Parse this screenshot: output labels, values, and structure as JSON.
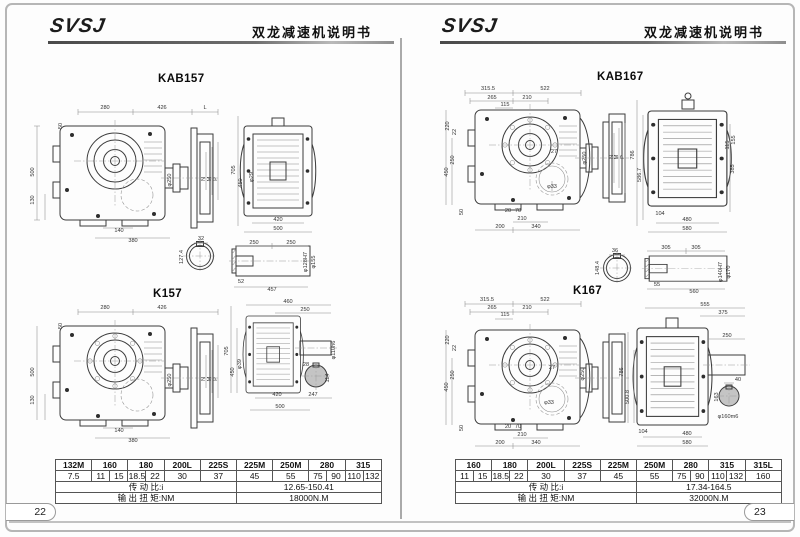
{
  "pages": [
    {
      "number": "22",
      "header": {
        "logo": "SVSJ",
        "doc_title": "双龙减速机说明书"
      },
      "figures": [
        {
          "title": "KAB157",
          "labels": [
            {
              "t": "280",
              "x": 80,
              "y": 49
            },
            {
              "t": "426",
              "x": 137,
              "y": 49
            },
            {
              "t": "L",
              "x": 180,
              "y": 49
            },
            {
              "t": "50",
              "x": 37,
              "y": 66,
              "r": 1
            },
            {
              "t": "500",
              "x": 9,
              "y": 112,
              "r": 1
            },
            {
              "t": "130",
              "x": 9,
              "y": 140,
              "r": 1
            },
            {
              "t": "140",
              "x": 94,
              "y": 172
            },
            {
              "t": "380",
              "x": 108,
              "y": 182
            },
            {
              "t": "φ250",
              "x": 146,
              "y": 120,
              "r": 1
            },
            {
              "t": "N",
              "x": 180,
              "y": 119,
              "r": 1
            },
            {
              "t": "M",
              "x": 186,
              "y": 119,
              "r": 1
            },
            {
              "t": "P",
              "x": 192,
              "y": 119,
              "r": 1
            },
            {
              "t": "705",
              "x": 210,
              "y": 110,
              "r": 1
            },
            {
              "t": "450",
              "x": 217,
              "y": 123,
              "r": 1
            },
            {
              "t": "φ29",
              "x": 228,
              "y": 117,
              "r": 1
            },
            {
              "t": "420",
              "x": 253,
              "y": 161
            },
            {
              "t": "500",
              "x": 253,
              "y": 170
            },
            {
              "t": "32",
              "x": 176,
              "y": 180
            },
            {
              "t": "127.4",
              "x": 158,
              "y": 197,
              "r": 1
            },
            {
              "t": "250",
              "x": 229,
              "y": 184
            },
            {
              "t": "250",
              "x": 266,
              "y": 184
            },
            {
              "t": "52",
              "x": 216,
              "y": 223
            },
            {
              "t": "457",
              "x": 247,
              "y": 231
            },
            {
              "t": "φ128H7",
              "x": 282,
              "y": 202,
              "r": 1
            },
            {
              "t": "φ155",
              "x": 290,
              "y": 202,
              "r": 1
            }
          ]
        },
        {
          "title": "K157",
          "labels": [
            {
              "t": "280",
              "x": 80,
              "y": 249
            },
            {
              "t": "426",
              "x": 137,
              "y": 249
            },
            {
              "t": "50",
              "x": 37,
              "y": 266,
              "r": 1
            },
            {
              "t": "500",
              "x": 9,
              "y": 312,
              "r": 1
            },
            {
              "t": "130",
              "x": 9,
              "y": 340,
              "r": 1
            },
            {
              "t": "140",
              "x": 94,
              "y": 372
            },
            {
              "t": "380",
              "x": 108,
              "y": 382
            },
            {
              "t": "φ250",
              "x": 146,
              "y": 320,
              "r": 1
            },
            {
              "t": "N",
              "x": 180,
              "y": 319,
              "r": 1
            },
            {
              "t": "M",
              "x": 186,
              "y": 319,
              "r": 1
            },
            {
              "t": "P",
              "x": 192,
              "y": 319,
              "r": 1
            },
            {
              "t": "460",
              "x": 263,
              "y": 243
            },
            {
              "t": "250",
              "x": 280,
              "y": 251
            },
            {
              "t": "705",
              "x": 203,
              "y": 291,
              "r": 1
            },
            {
              "t": "450",
              "x": 209,
              "y": 312,
              "r": 1
            },
            {
              "t": "φ39",
              "x": 216,
              "y": 304,
              "r": 1
            },
            {
              "t": "420",
              "x": 252,
              "y": 336
            },
            {
              "t": "247",
              "x": 288,
              "y": 336
            },
            {
              "t": "500",
              "x": 255,
              "y": 348
            },
            {
              "t": "φ110h6",
              "x": 310,
              "y": 290,
              "r": 1
            },
            {
              "t": "28",
              "x": 281,
              "y": 306
            },
            {
              "t": "114",
              "x": 304,
              "y": 318,
              "r": 1
            }
          ]
        }
      ],
      "table": {
        "models": [
          "132M",
          "160",
          "180",
          "200L",
          "225S",
          "225M",
          "250M",
          "280",
          "315"
        ],
        "powers": [
          "7.5",
          "11",
          "15",
          "18.5",
          "22",
          "30",
          "37",
          "45",
          "55",
          "75",
          "90",
          "110",
          "132"
        ],
        "ratio_label": "传 动 比:i",
        "ratio_value": "12.65-150.41",
        "torque_label": "输 出 扭 矩:NM",
        "torque_value": "18000N.M"
      }
    },
    {
      "number": "23",
      "header": {
        "logo": "SVSJ",
        "doc_title": "双龙减速机说明书"
      },
      "figures": [
        {
          "title": "KAB167",
          "labels": [
            {
              "t": "315.5",
              "x": 63,
              "y": 30
            },
            {
              "t": "522",
              "x": 120,
              "y": 30
            },
            {
              "t": "265",
              "x": 67,
              "y": 39
            },
            {
              "t": "210",
              "x": 102,
              "y": 39
            },
            {
              "t": "115",
              "x": 80,
              "y": 46
            },
            {
              "t": "220",
              "x": 24,
              "y": 66,
              "r": 1
            },
            {
              "t": "22",
              "x": 31,
              "y": 72,
              "r": 1
            },
            {
              "t": "250",
              "x": 29,
              "y": 100,
              "r": 1
            },
            {
              "t": "450",
              "x": 23,
              "y": 112,
              "r": 1
            },
            {
              "t": "50",
              "x": 38,
              "y": 152,
              "r": 1
            },
            {
              "t": "20",
              "x": 83,
              "y": 152
            },
            {
              "t": "70",
              "x": 93,
              "y": 152
            },
            {
              "t": "210",
              "x": 97,
              "y": 160
            },
            {
              "t": "200",
              "x": 75,
              "y": 168
            },
            {
              "t": "340",
              "x": 111,
              "y": 168
            },
            {
              "t": "φ33",
              "x": 127,
              "y": 128
            },
            {
              "t": "27",
              "x": 129,
              "y": 93
            },
            {
              "t": "φ250",
              "x": 161,
              "y": 98,
              "r": 1
            },
            {
              "t": "N",
              "x": 188,
              "y": 97,
              "r": 1
            },
            {
              "t": "M",
              "x": 193,
              "y": 97,
              "r": 1
            },
            {
              "t": "P",
              "x": 199,
              "y": 97,
              "r": 1
            },
            {
              "t": "786",
              "x": 209,
              "y": 95,
              "r": 1
            },
            {
              "t": "586.7",
              "x": 216,
              "y": 115,
              "r": 1
            },
            {
              "t": "104",
              "x": 235,
              "y": 155
            },
            {
              "t": "480",
              "x": 262,
              "y": 161
            },
            {
              "t": "580",
              "x": 262,
              "y": 170
            },
            {
              "t": "155",
              "x": 310,
              "y": 80,
              "r": 1
            },
            {
              "t": "115",
              "x": 304,
              "y": 85,
              "r": 1
            },
            {
              "t": "385",
              "x": 309,
              "y": 109,
              "r": 1
            },
            {
              "t": "36",
              "x": 190,
              "y": 192
            },
            {
              "t": "148.4",
              "x": 174,
              "y": 208,
              "r": 1
            },
            {
              "t": "305",
              "x": 241,
              "y": 189
            },
            {
              "t": "305",
              "x": 271,
              "y": 189
            },
            {
              "t": "55",
              "x": 232,
              "y": 226
            },
            {
              "t": "560",
              "x": 269,
              "y": 233
            },
            {
              "t": "φ140H7",
              "x": 297,
              "y": 212,
              "r": 1
            },
            {
              "t": "φ170",
              "x": 305,
              "y": 212,
              "r": 1
            }
          ]
        },
        {
          "title": "K167",
          "labels": [
            {
              "t": "315.5",
              "x": 62,
              "y": 241
            },
            {
              "t": "522",
              "x": 120,
              "y": 241
            },
            {
              "t": "265",
              "x": 67,
              "y": 249
            },
            {
              "t": "210",
              "x": 102,
              "y": 249
            },
            {
              "t": "115",
              "x": 80,
              "y": 256
            },
            {
              "t": "220",
              "x": 24,
              "y": 280,
              "r": 1
            },
            {
              "t": "22",
              "x": 31,
              "y": 288,
              "r": 1
            },
            {
              "t": "250",
              "x": 29,
              "y": 315,
              "r": 1
            },
            {
              "t": "450",
              "x": 23,
              "y": 327,
              "r": 1
            },
            {
              "t": "50",
              "x": 38,
              "y": 368,
              "r": 1
            },
            {
              "t": "20",
              "x": 83,
              "y": 368
            },
            {
              "t": "70",
              "x": 93,
              "y": 368
            },
            {
              "t": "210",
              "x": 97,
              "y": 376
            },
            {
              "t": "200",
              "x": 75,
              "y": 384
            },
            {
              "t": "340",
              "x": 111,
              "y": 384
            },
            {
              "t": "φ33",
              "x": 124,
              "y": 344
            },
            {
              "t": "27",
              "x": 127,
              "y": 309
            },
            {
              "t": "φ250",
              "x": 159,
              "y": 314,
              "r": 1
            },
            {
              "t": "786",
              "x": 198,
              "y": 312,
              "r": 1
            },
            {
              "t": "500.8",
              "x": 204,
              "y": 337,
              "r": 1
            },
            {
              "t": "555",
              "x": 280,
              "y": 246
            },
            {
              "t": "375",
              "x": 298,
              "y": 254
            },
            {
              "t": "250",
              "x": 302,
              "y": 277
            },
            {
              "t": "104",
              "x": 218,
              "y": 373
            },
            {
              "t": "480",
              "x": 262,
              "y": 375
            },
            {
              "t": "580",
              "x": 262,
              "y": 384
            },
            {
              "t": "40",
              "x": 313,
              "y": 321
            },
            {
              "t": "163",
              "x": 293,
              "y": 337,
              "r": 1
            },
            {
              "t": "φ160m6",
              "x": 303,
              "y": 358
            }
          ]
        }
      ],
      "table": {
        "models": [
          "160",
          "180",
          "200L",
          "225S",
          "225M",
          "250M",
          "280",
          "315",
          "315L"
        ],
        "powers": [
          "11",
          "15",
          "18.5",
          "22",
          "30",
          "37",
          "45",
          "55",
          "75",
          "90",
          "110",
          "132",
          "160"
        ],
        "ratio_label": "传 动 比:i",
        "ratio_value": "17.34-164.5",
        "torque_label": "输 出 扭 矩:NM",
        "torque_value": "32000N.M"
      }
    }
  ]
}
